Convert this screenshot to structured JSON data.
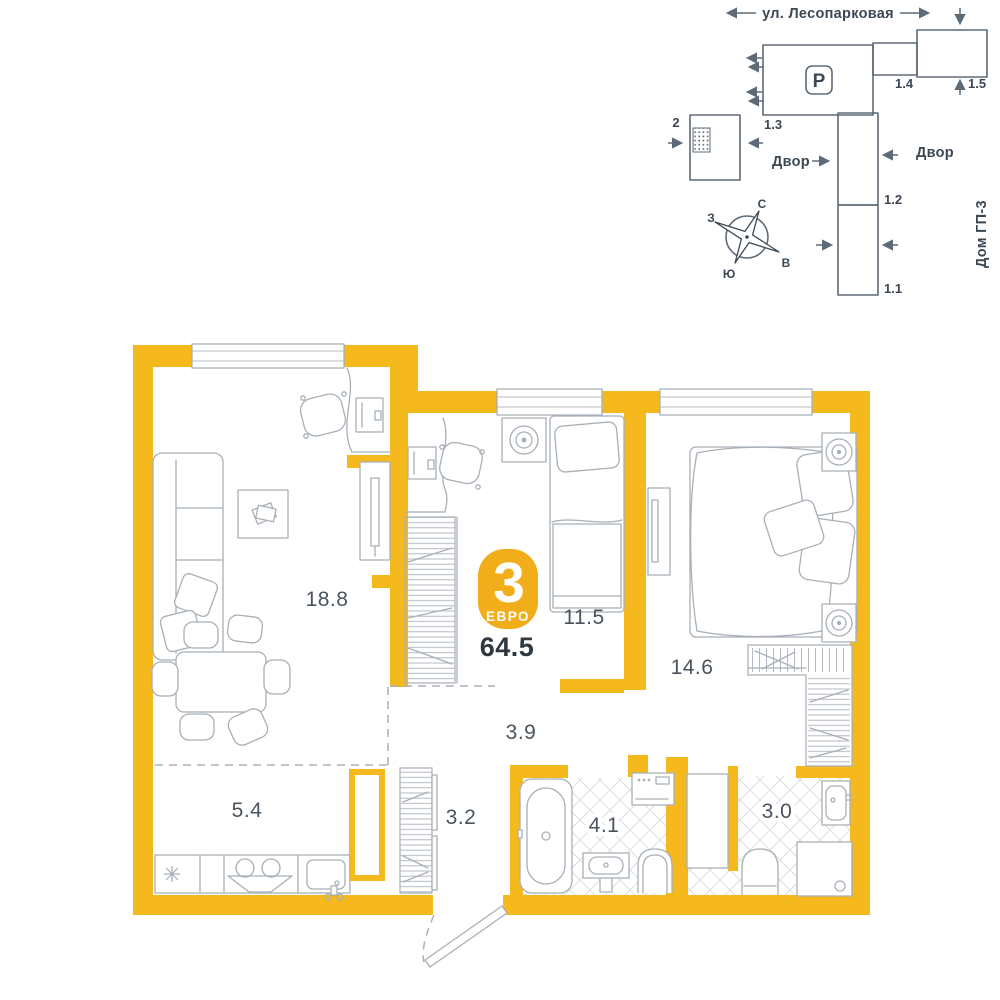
{
  "site_plan": {
    "street": "ул. Лесопарковая",
    "yard_left": "Двор",
    "yard_right": "Двор",
    "neighbor_house": "Дом ГП-3",
    "parking": "Р",
    "building_current": "2",
    "building_1_1": "1.1",
    "building_1_2": "1.2",
    "building_1_3": "1.3",
    "building_1_4": "1.4",
    "building_1_5": "1.5",
    "compass": {
      "north": "С",
      "south": "Ю",
      "west": "З",
      "east": "В"
    }
  },
  "apartment": {
    "rooms_count": "3",
    "layout_type": "ЕВРО",
    "total_area": "64.5",
    "rooms": [
      {
        "name": "living-room",
        "area": "18.8"
      },
      {
        "name": "bedroom-1",
        "area": "11.5"
      },
      {
        "name": "bedroom-2",
        "area": "14.6"
      },
      {
        "name": "hallway",
        "area": "3.9"
      },
      {
        "name": "kitchen",
        "area": "5.4"
      },
      {
        "name": "corridor",
        "area": "3.2"
      },
      {
        "name": "bathroom",
        "area": "4.1"
      },
      {
        "name": "wc",
        "area": "3.0"
      }
    ]
  },
  "colors": {
    "wall": "#F5B91E",
    "badge": "#F1AD1A",
    "furniture_line": "#A8AFB7",
    "site_line": "#5D6B78",
    "room_label": "#4A545E",
    "total_label": "#2F3840"
  }
}
